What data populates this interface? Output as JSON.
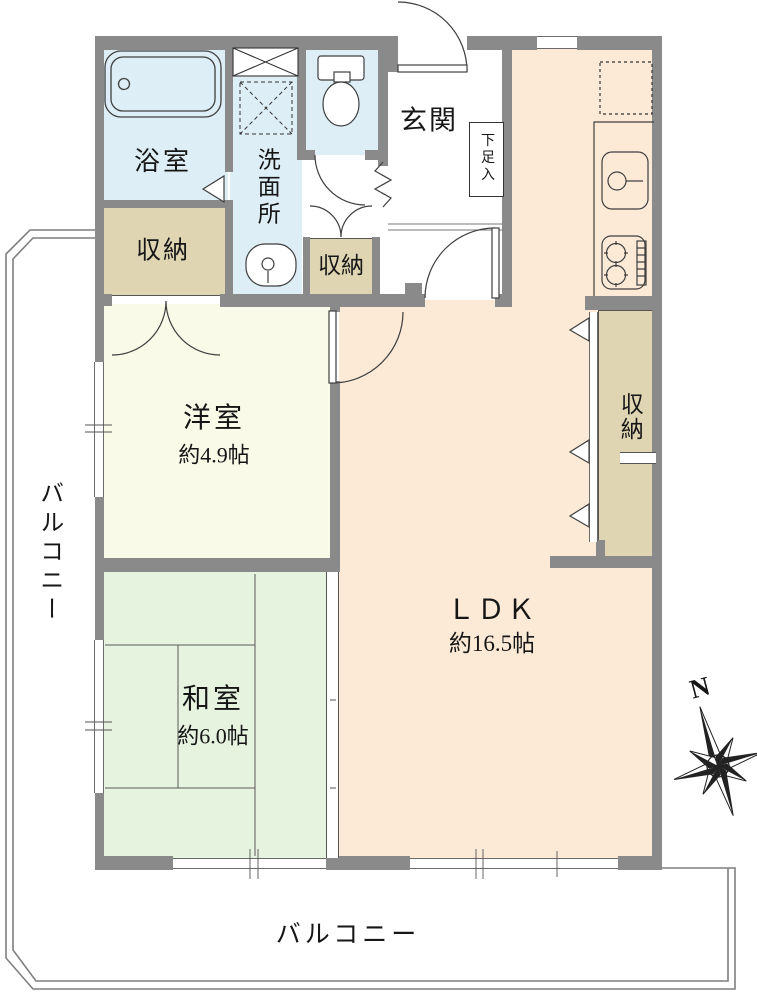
{
  "rooms": {
    "ldk": {
      "label": "ＬＤＫ",
      "size": "約16.5帖"
    },
    "western_room": {
      "label": "洋室",
      "size": "約4.9帖"
    },
    "japanese_room": {
      "label": "和室",
      "size": "約6.0帖"
    },
    "genkan": {
      "label": "玄関"
    },
    "bathroom": {
      "label": "浴室"
    },
    "washroom": {
      "label": "洗面所"
    },
    "storage_bath": {
      "label": "収納"
    },
    "storage_hall": {
      "label": "収納"
    },
    "storage_ldk": {
      "label": "収納"
    },
    "shoe_cabinet": {
      "label": "下足入"
    },
    "balcony_left": {
      "label": "バルコニー"
    },
    "balcony_bottom": {
      "label": "バルコニー"
    }
  },
  "compass": {
    "north_label": "N"
  },
  "colors": {
    "wall": "#8a8a8a",
    "ldk": "#fcead7",
    "western_room": "#fafae8",
    "japanese_room": "#e6f3df",
    "storage": "#e0d5b3",
    "wet_area": "#ddeef6",
    "line": "#3f3f3f"
  }
}
